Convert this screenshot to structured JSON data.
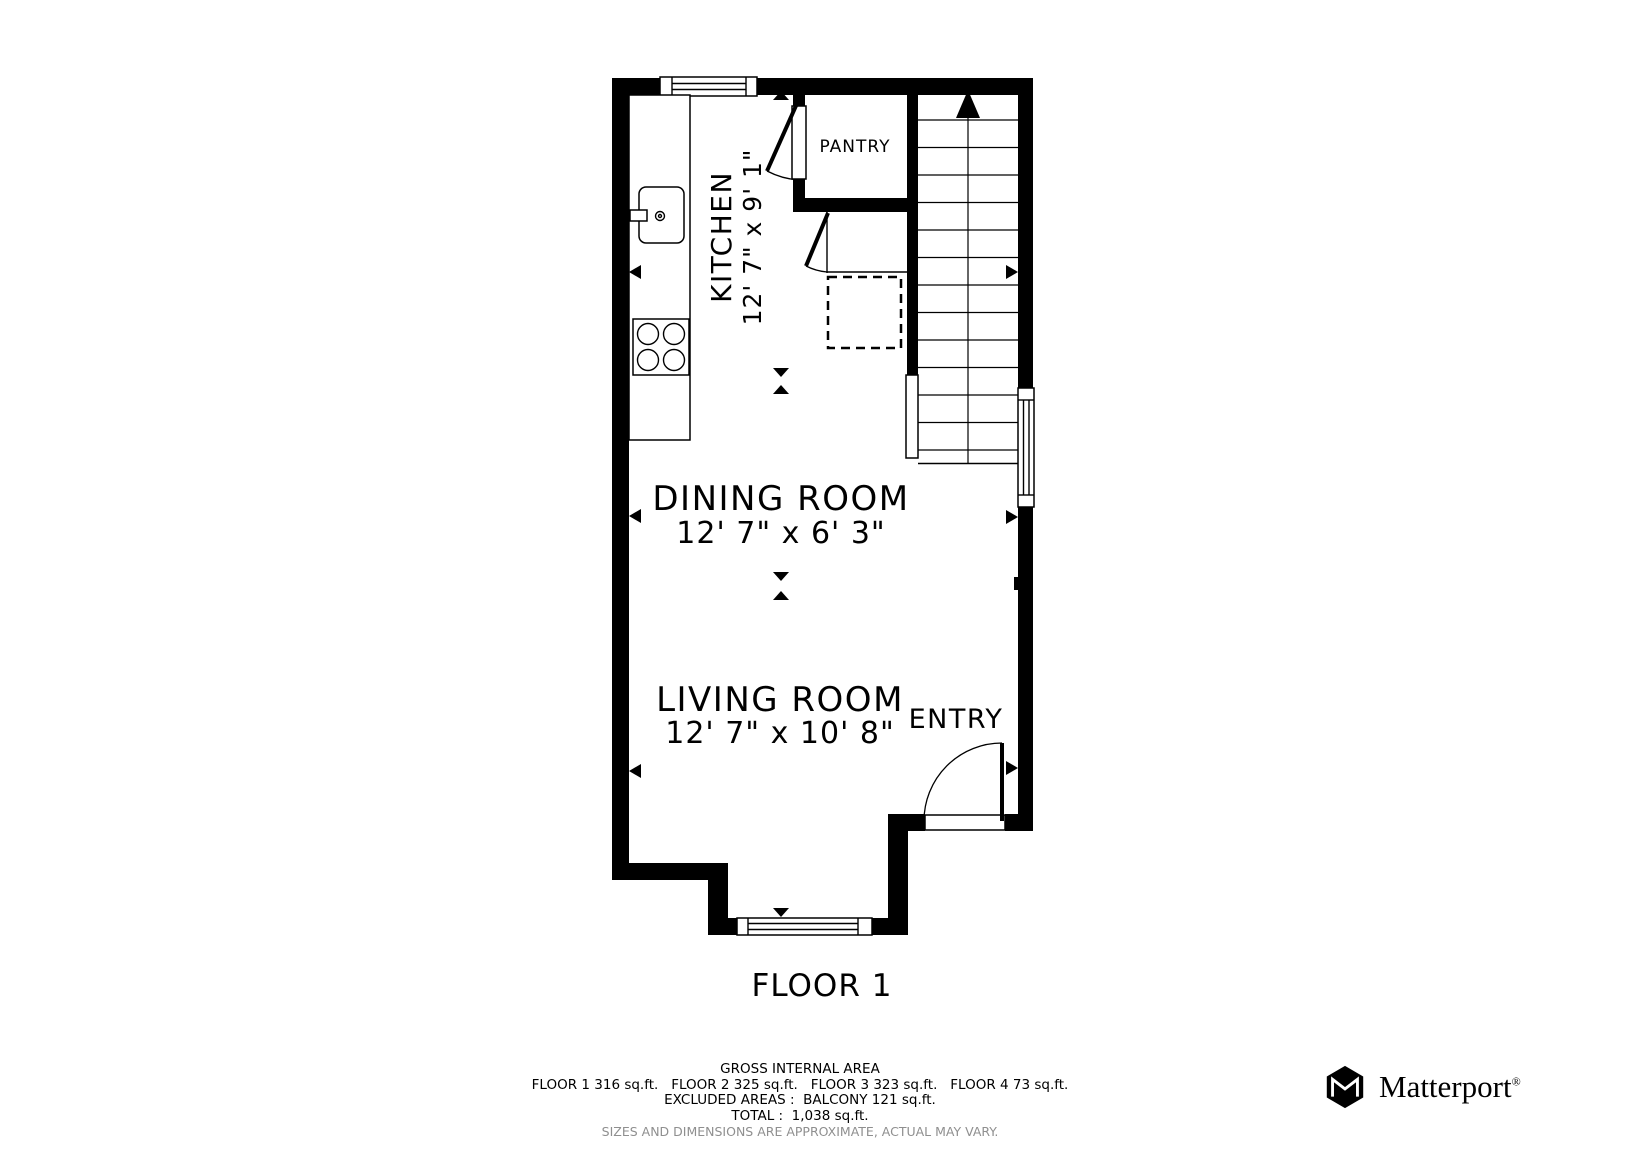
{
  "plan": {
    "floor_label": "FLOOR 1",
    "rooms": {
      "kitchen": {
        "name": "KITCHEN",
        "dims": "12' 7\" x 9' 1\""
      },
      "pantry": {
        "name": "PANTRY"
      },
      "dining_room": {
        "name": "DINING ROOM",
        "dims": "12' 7\" x 6' 3\""
      },
      "living_room": {
        "name": "LIVING ROOM",
        "dims": "12' 7\" x 10' 8\""
      },
      "entry": {
        "name": "ENTRY"
      }
    }
  },
  "area_summary": {
    "title": "GROSS INTERNAL AREA",
    "floors": "FLOOR 1 316 sq.ft.   FLOOR 2 325 sq.ft.   FLOOR 3 323 sq.ft.   FLOOR 4 73 sq.ft.",
    "excluded": "EXCLUDED AREAS :  BALCONY 121 sq.ft.",
    "total": "TOTAL :  1,038 sq.ft.",
    "disclaimer": "SIZES AND DIMENSIONS ARE APPROXIMATE, ACTUAL MAY VARY."
  },
  "branding": {
    "name": "Matterport",
    "registered_mark": "®"
  },
  "colors": {
    "wall": "#000000",
    "background": "#ffffff",
    "disclaimer_gray": "#8f8f8f"
  }
}
